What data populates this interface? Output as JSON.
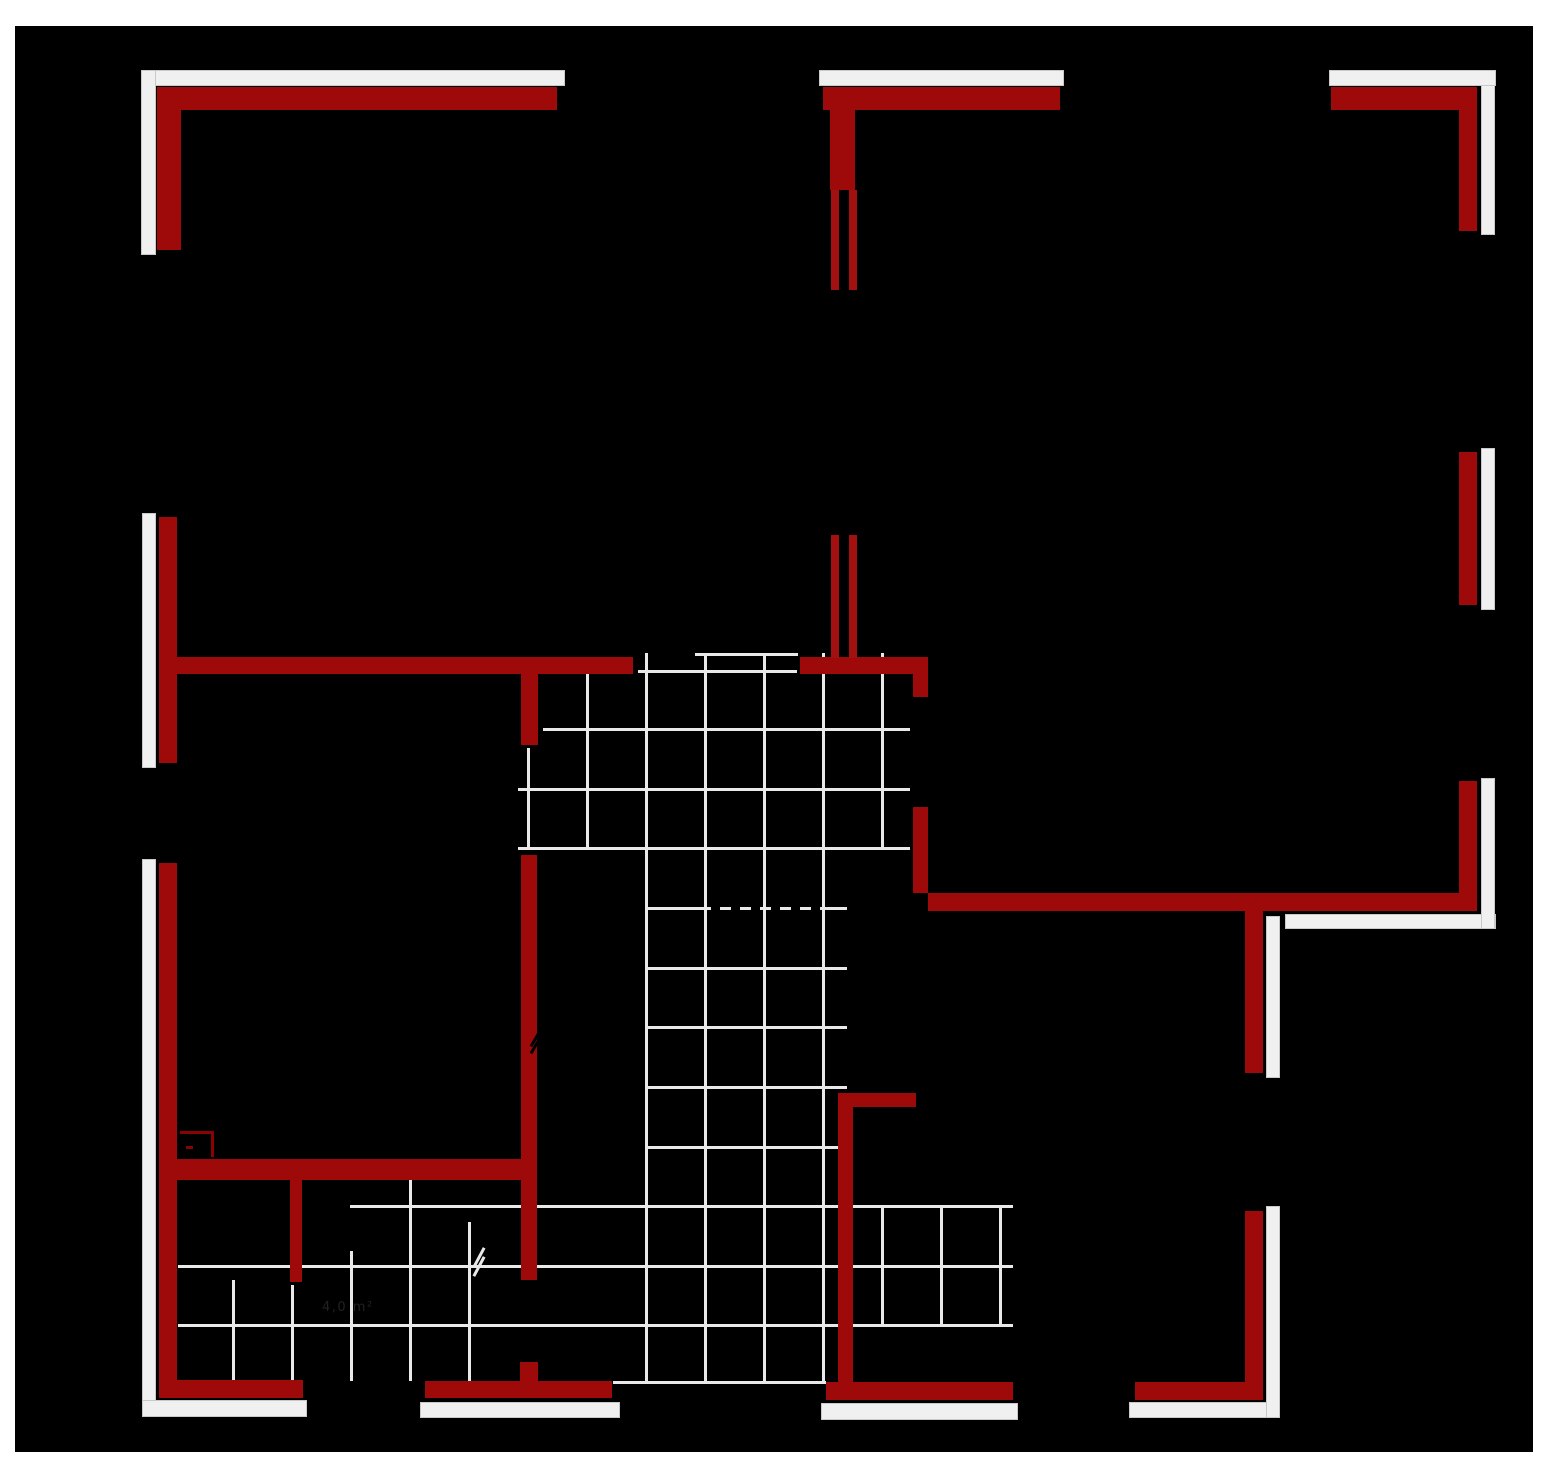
{
  "title": "floor-plan-drawing",
  "colors": {
    "page_background": "#ffffff",
    "drawing_background": "#000000",
    "wall_red": "#9e0a0a",
    "window_jamb_red": "#a21010",
    "fixture_red": "#8a0303",
    "exterior_band_white": "#f0f0f0",
    "tile_grid_gray": "#e9e9e9",
    "label_gray": "#282828"
  },
  "room_label": {
    "text": "4,0 m²",
    "x": 322,
    "y": 1300
  },
  "canvas": {
    "black_rect": {
      "x": 15,
      "y": 26,
      "w": 1518,
      "h": 1426
    }
  },
  "plan": {
    "red_walls": [
      {
        "x": 157,
        "y": 87,
        "w": 400,
        "h": 23
      },
      {
        "x": 157,
        "y": 87,
        "w": 24,
        "h": 163
      },
      {
        "x": 159,
        "y": 517,
        "w": 18,
        "h": 246
      },
      {
        "x": 159,
        "y": 863,
        "w": 18,
        "h": 535
      },
      {
        "x": 159,
        "y": 1380,
        "w": 144,
        "h": 18
      },
      {
        "x": 425,
        "y": 1381,
        "w": 187,
        "h": 17
      },
      {
        "x": 520,
        "y": 1362,
        "w": 18,
        "h": 20
      },
      {
        "x": 176,
        "y": 657,
        "w": 457,
        "h": 17
      },
      {
        "x": 521,
        "y": 674,
        "w": 17,
        "h": 71
      },
      {
        "x": 521,
        "y": 855,
        "w": 16,
        "h": 425
      },
      {
        "x": 177,
        "y": 1159,
        "w": 350,
        "h": 21
      },
      {
        "x": 290,
        "y": 1180,
        "w": 12,
        "h": 102
      },
      {
        "x": 823,
        "y": 87,
        "w": 237,
        "h": 23
      },
      {
        "x": 830,
        "y": 110,
        "w": 25,
        "h": 80
      },
      {
        "x": 800,
        "y": 657,
        "w": 128,
        "h": 17
      },
      {
        "x": 913,
        "y": 674,
        "w": 15,
        "h": 23
      },
      {
        "x": 913,
        "y": 807,
        "w": 15,
        "h": 86
      },
      {
        "x": 928,
        "y": 893,
        "w": 533,
        "h": 18
      },
      {
        "x": 838,
        "y": 1093,
        "w": 15,
        "h": 289
      },
      {
        "x": 838,
        "y": 1093,
        "w": 78,
        "h": 14
      },
      {
        "x": 826,
        "y": 1382,
        "w": 187,
        "h": 18
      },
      {
        "x": 1135,
        "y": 1382,
        "w": 128,
        "h": 18
      },
      {
        "x": 1245,
        "y": 1211,
        "w": 18,
        "h": 189
      },
      {
        "x": 1245,
        "y": 911,
        "w": 18,
        "h": 162
      },
      {
        "x": 1331,
        "y": 87,
        "w": 146,
        "h": 23
      },
      {
        "x": 1459,
        "y": 110,
        "w": 18,
        "h": 121
      },
      {
        "x": 1459,
        "y": 452,
        "w": 18,
        "h": 153
      },
      {
        "x": 1459,
        "y": 781,
        "w": 18,
        "h": 130
      }
    ],
    "window_jambs": [
      {
        "x": 831,
        "y": 190,
        "w": 8,
        "h": 100
      },
      {
        "x": 849,
        "y": 190,
        "w": 8,
        "h": 100
      },
      {
        "x": 831,
        "y": 535,
        "w": 8,
        "h": 123
      },
      {
        "x": 849,
        "y": 535,
        "w": 8,
        "h": 123
      }
    ],
    "fixture_lines": [
      {
        "x": 180,
        "y": 1131,
        "w": 34,
        "h": 3
      },
      {
        "x": 211,
        "y": 1131,
        "w": 3,
        "h": 26
      },
      {
        "x": 186,
        "y": 1146,
        "w": 7,
        "h": 3
      }
    ],
    "white_bands": [
      {
        "x": 141,
        "y": 70,
        "w": 424,
        "h": 16
      },
      {
        "x": 141,
        "y": 70,
        "w": 15,
        "h": 185
      },
      {
        "x": 142,
        "y": 513,
        "w": 14,
        "h": 255
      },
      {
        "x": 142,
        "y": 859,
        "w": 14,
        "h": 558
      },
      {
        "x": 142,
        "y": 1400,
        "w": 165,
        "h": 17
      },
      {
        "x": 420,
        "y": 1402,
        "w": 200,
        "h": 16
      },
      {
        "x": 819,
        "y": 70,
        "w": 245,
        "h": 16
      },
      {
        "x": 821,
        "y": 1403,
        "w": 197,
        "h": 17
      },
      {
        "x": 1129,
        "y": 1402,
        "w": 151,
        "h": 16
      },
      {
        "x": 1266,
        "y": 1206,
        "w": 14,
        "h": 212
      },
      {
        "x": 1266,
        "y": 916,
        "w": 14,
        "h": 162
      },
      {
        "x": 1285,
        "y": 914,
        "w": 211,
        "h": 15
      },
      {
        "x": 1481,
        "y": 778,
        "w": 14,
        "h": 151
      },
      {
        "x": 1481,
        "y": 448,
        "w": 14,
        "h": 162
      },
      {
        "x": 1481,
        "y": 70,
        "w": 14,
        "h": 165
      },
      {
        "x": 1329,
        "y": 70,
        "w": 167,
        "h": 16
      }
    ],
    "grid_vlines": [
      {
        "x": 232,
        "y1": 1280,
        "y2": 1381
      },
      {
        "x": 291,
        "y1": 1285,
        "y2": 1381
      },
      {
        "x": 350,
        "y1": 1251,
        "y2": 1381
      },
      {
        "x": 409,
        "y1": 1172,
        "y2": 1381
      },
      {
        "x": 468,
        "y1": 1222,
        "y2": 1381
      },
      {
        "x": 527,
        "y1": 748,
        "y2": 847
      },
      {
        "x": 586,
        "y1": 670,
        "y2": 848
      },
      {
        "x": 645,
        "y1": 653,
        "y2": 1381
      },
      {
        "x": 704,
        "y1": 653,
        "y2": 1381
      },
      {
        "x": 763,
        "y1": 653,
        "y2": 1381
      },
      {
        "x": 822,
        "y1": 653,
        "y2": 1381
      },
      {
        "x": 881,
        "y1": 653,
        "y2": 848
      },
      {
        "x": 881,
        "y1": 1205,
        "y2": 1324
      },
      {
        "x": 940,
        "y1": 1205,
        "y2": 1324
      },
      {
        "x": 999,
        "y1": 1205,
        "y2": 1324
      }
    ],
    "grid_hlines": [
      {
        "y": 653,
        "x1": 695,
        "x2": 798,
        "dashed": false
      },
      {
        "y": 670,
        "x1": 638,
        "x2": 797,
        "dashed": false
      },
      {
        "y": 728,
        "x1": 543,
        "x2": 910,
        "dashed": false
      },
      {
        "y": 788,
        "x1": 518,
        "x2": 910,
        "dashed": false
      },
      {
        "y": 847,
        "x1": 518,
        "x2": 910,
        "dashed": false
      },
      {
        "y": 907,
        "x1": 645,
        "x2": 700,
        "dashed": false
      },
      {
        "y": 907,
        "x1": 700,
        "x2": 830,
        "dashed": true
      },
      {
        "y": 907,
        "x1": 830,
        "x2": 847,
        "dashed": false
      },
      {
        "y": 967,
        "x1": 645,
        "x2": 847,
        "dashed": false
      },
      {
        "y": 1026,
        "x1": 645,
        "x2": 847,
        "dashed": false
      },
      {
        "y": 1086,
        "x1": 645,
        "x2": 847,
        "dashed": false
      },
      {
        "y": 1146,
        "x1": 645,
        "x2": 847,
        "dashed": false
      },
      {
        "y": 1205,
        "x1": 350,
        "x2": 1013,
        "dashed": false
      },
      {
        "y": 1265,
        "x1": 178,
        "x2": 1013,
        "dashed": false
      },
      {
        "y": 1324,
        "x1": 178,
        "x2": 1013,
        "dashed": false
      },
      {
        "y": 1381,
        "x1": 613,
        "x2": 826,
        "dashed": false
      }
    ],
    "break_marks": [
      {
        "x": 527,
        "y": 1038,
        "angle": -60,
        "gap": 7,
        "color": "#000000",
        "len": 16
      },
      {
        "x": 468,
        "y": 1256,
        "angle": -62,
        "gap": 9,
        "color": "#e9e9e9",
        "len": 22
      }
    ]
  }
}
